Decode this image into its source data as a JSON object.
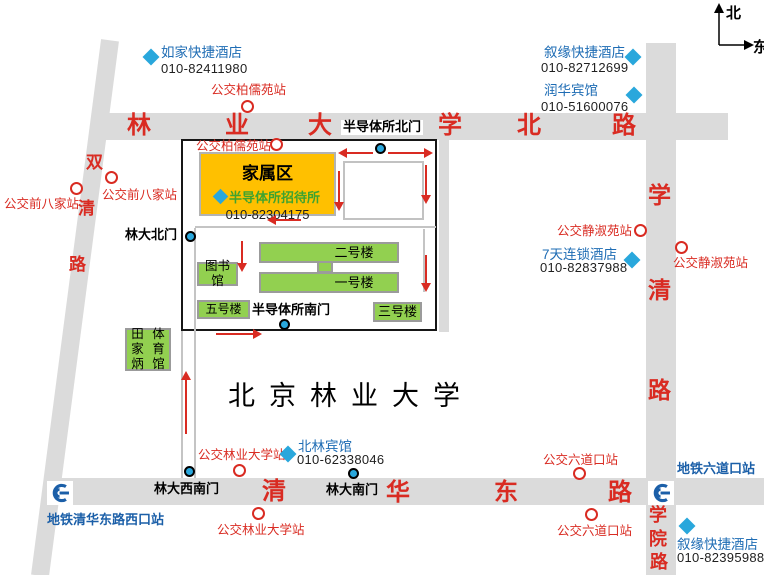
{
  "colors": {
    "road_gray": "#dbdbdb",
    "map_red": "#d92b22",
    "hotel_blue": "#1e6cb4",
    "diamond_cyan": "#29a7dc",
    "building_green": "#92d050",
    "family_area_yellow": "#ffc000",
    "subway_blue": "#1b5fa8",
    "guesthouse_green_text": "#3fa32f"
  },
  "compass": {
    "north": "北",
    "east": "东"
  },
  "campus": {
    "name": "北京林业大学"
  },
  "guesthouse": {
    "area_label": "家属区",
    "name": "半导体所招待所",
    "phone": "010-82304175"
  },
  "roads": {
    "top": {
      "name": "林业大学北路",
      "size": 24,
      "chars": [
        {
          "t": "林",
          "x": 127,
          "y": 114
        },
        {
          "t": "业",
          "x": 225,
          "y": 114
        },
        {
          "t": "大",
          "x": 308,
          "y": 114
        },
        {
          "t": "学",
          "x": 438,
          "y": 114
        },
        {
          "t": "北",
          "x": 517,
          "y": 114
        },
        {
          "t": "路",
          "x": 612,
          "y": 114
        }
      ]
    },
    "right": {
      "name": "学清路",
      "size": 23,
      "chars": [
        {
          "t": "学",
          "x": 648,
          "y": 184
        },
        {
          "t": "清",
          "x": 648,
          "y": 279
        },
        {
          "t": "路",
          "x": 648,
          "y": 379
        }
      ]
    },
    "bottom": {
      "name": "清华东路",
      "size": 24,
      "chars": [
        {
          "t": "清",
          "x": 262,
          "y": 480
        },
        {
          "t": "华",
          "x": 386,
          "y": 481
        },
        {
          "t": "东",
          "x": 494,
          "y": 481
        },
        {
          "t": "路",
          "x": 608,
          "y": 481
        }
      ]
    },
    "xueyuan": {
      "name": "学院路",
      "size": 18,
      "chars": [
        {
          "t": "学",
          "x": 649,
          "y": 506
        },
        {
          "t": "院",
          "x": 649,
          "y": 530
        },
        {
          "t": "路",
          "x": 650,
          "y": 553
        }
      ]
    },
    "diagonal": {
      "name": "双清路",
      "size": 17,
      "chars": [
        {
          "t": "双",
          "x": 86,
          "y": 154
        },
        {
          "t": "清",
          "x": 78,
          "y": 200
        },
        {
          "t": "路",
          "x": 69,
          "y": 256
        }
      ]
    }
  },
  "hotels": [
    {
      "name": "如家快捷酒店",
      "phone": "010-82411980",
      "nx": 161,
      "ny": 45,
      "px": 161,
      "py": 62,
      "dx": 151,
      "dy": 57
    },
    {
      "name": "叙缘快捷酒店",
      "phone": "010-82712699",
      "nx": 544,
      "ny": 45,
      "px": 541,
      "py": 61,
      "dx": 633,
      "dy": 57
    },
    {
      "name": "润华宾馆",
      "phone": "010-51600076",
      "nx": 544,
      "ny": 83,
      "px": 541,
      "py": 100,
      "dx": 634,
      "dy": 95
    },
    {
      "name": "7天连锁酒店",
      "phone": "010-82837988",
      "nx": 542,
      "ny": 247,
      "px": 540,
      "py": 261,
      "dx": 632,
      "dy": 260
    },
    {
      "name": "北林宾馆",
      "phone": "010-62338046",
      "nx": 298,
      "ny": 439,
      "px": 297,
      "py": 453,
      "dx": 288,
      "dy": 454
    },
    {
      "name": "叙缘快捷酒店",
      "phone": "010-82395988",
      "nx": 677,
      "ny": 537,
      "px": 677,
      "py": 551,
      "dx": 687,
      "dy": 526
    }
  ],
  "bus_stops": [
    {
      "label": "公交柏儒苑站",
      "cx": 248,
      "cy": 107,
      "lx": 211,
      "ly": 83
    },
    {
      "label": "公交柏儒苑站",
      "cx": 277,
      "cy": 145,
      "lx": 196,
      "ly": 139
    },
    {
      "label": "公交前八家站",
      "cx": 112,
      "cy": 178,
      "lx": 102,
      "ly": 188
    },
    {
      "label": "公交前八家站",
      "cx": 77,
      "cy": 189,
      "lx": 4,
      "ly": 197
    },
    {
      "label": "公交静淑苑站",
      "cx": 641,
      "cy": 231,
      "lx": 557,
      "ly": 224
    },
    {
      "label": "公交静淑苑站",
      "cx": 682,
      "cy": 248,
      "lx": 673,
      "ly": 256
    },
    {
      "label": "公交六道口站",
      "cx": 580,
      "cy": 474,
      "lx": 543,
      "ly": 453
    },
    {
      "label": "公交六道口站",
      "cx": 592,
      "cy": 515,
      "lx": 557,
      "ly": 524
    },
    {
      "label": "公交林业大学站",
      "cx": 240,
      "cy": 471,
      "lx": 198,
      "ly": 448
    },
    {
      "label": "公交林业大学站",
      "cx": 259,
      "cy": 514,
      "lx": 217,
      "ly": 523
    }
  ],
  "gates": [
    {
      "label": "半导体所北门",
      "cx": 380,
      "cy": 148,
      "lx": 341,
      "ly": 120,
      "bg": true
    },
    {
      "label": "林大北门",
      "cx": 190,
      "cy": 236,
      "lx": 125,
      "ly": 228,
      "bg": false
    },
    {
      "label": "半导体所南门",
      "cx": 284,
      "cy": 324,
      "lx": 252,
      "ly": 303,
      "bg": false
    },
    {
      "label": "林大西南门",
      "cx": 189,
      "cy": 471,
      "lx": 154,
      "ly": 482,
      "bg": false
    },
    {
      "label": "林大南门",
      "cx": 353,
      "cy": 473,
      "lx": 326,
      "ly": 483,
      "bg": false
    }
  ],
  "subway_stations": [
    {
      "label": "地铁清华东路西口站",
      "bx": 47,
      "by": 481,
      "lx": 47,
      "ly": 513
    },
    {
      "label": "地铁六道口站",
      "bx": 648,
      "by": 481,
      "lx": 677,
      "ly": 462
    }
  ],
  "buildings": [
    {
      "lines": [
        "二号楼"
      ],
      "x": 259,
      "y": 242,
      "w": 140,
      "h": 21,
      "fs": 13,
      "pad": 50
    },
    {
      "lines": [],
      "x": 317,
      "y": 261,
      "w": 16,
      "h": 12,
      "fs": 0,
      "pad": 0
    },
    {
      "lines": [
        "一号楼"
      ],
      "x": 259,
      "y": 272,
      "w": 140,
      "h": 21,
      "fs": 13,
      "pad": 50
    },
    {
      "lines": [
        "图书馆"
      ],
      "x": 197,
      "y": 262,
      "w": 41,
      "h": 24,
      "fs": 12.5,
      "pad": 0
    },
    {
      "lines": [
        "五号楼"
      ],
      "x": 197,
      "y": 300,
      "w": 53,
      "h": 19,
      "fs": 12,
      "pad": 0
    },
    {
      "lines": [
        "三号楼"
      ],
      "x": 373,
      "y": 302,
      "w": 49,
      "h": 20,
      "fs": 13,
      "pad": 0
    },
    {
      "lines": [
        "田家炳",
        "体育馆"
      ],
      "x": 125,
      "y": 328,
      "w": 46,
      "h": 43,
      "fs": 12.5,
      "pad": 0
    }
  ],
  "arrows": [
    {
      "d": "left",
      "x": 347,
      "y": 153,
      "len": 26
    },
    {
      "d": "right",
      "x": 388,
      "y": 153,
      "len": 36
    },
    {
      "d": "down",
      "x": 339,
      "y": 171,
      "len": 31
    },
    {
      "d": "down",
      "x": 426,
      "y": 165,
      "len": 30
    },
    {
      "d": "left",
      "x": 276,
      "y": 220,
      "len": 25
    },
    {
      "d": "down",
      "x": 242,
      "y": 241,
      "len": 22
    },
    {
      "d": "down",
      "x": 426,
      "y": 255,
      "len": 28
    },
    {
      "d": "right",
      "x": 216,
      "y": 334,
      "len": 37
    },
    {
      "d": "up",
      "x": 186,
      "y": 380,
      "len": 54
    }
  ]
}
